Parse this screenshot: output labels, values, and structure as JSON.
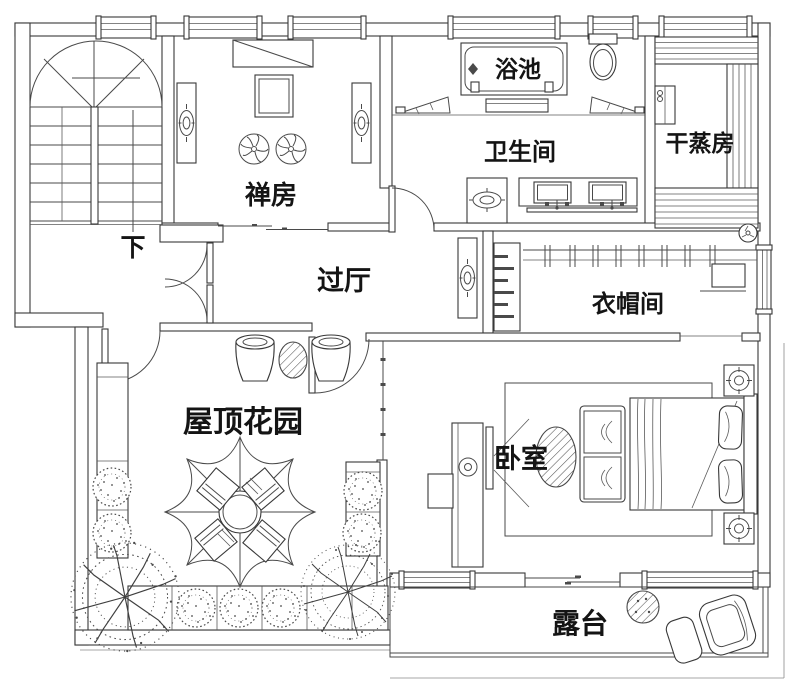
{
  "floorplan": {
    "rooms": {
      "stairs": {
        "label": "下"
      },
      "meditation_room": {
        "label": "禅房"
      },
      "bath_pool": {
        "label": "浴池"
      },
      "bathroom": {
        "label": "卫生间"
      },
      "dry_sauna": {
        "label": "干蒸房"
      },
      "hallway": {
        "label": "过厅"
      },
      "cloakroom": {
        "label": "衣帽间"
      },
      "roof_garden": {
        "label": "屋顶花园"
      },
      "bedroom": {
        "label": "卧室"
      },
      "terrace": {
        "label": "露台"
      }
    },
    "colors": {
      "wall_line": "#383838",
      "furniture_line": "#4a4a4a",
      "text": "#141414",
      "background": "#ffffff"
    }
  }
}
